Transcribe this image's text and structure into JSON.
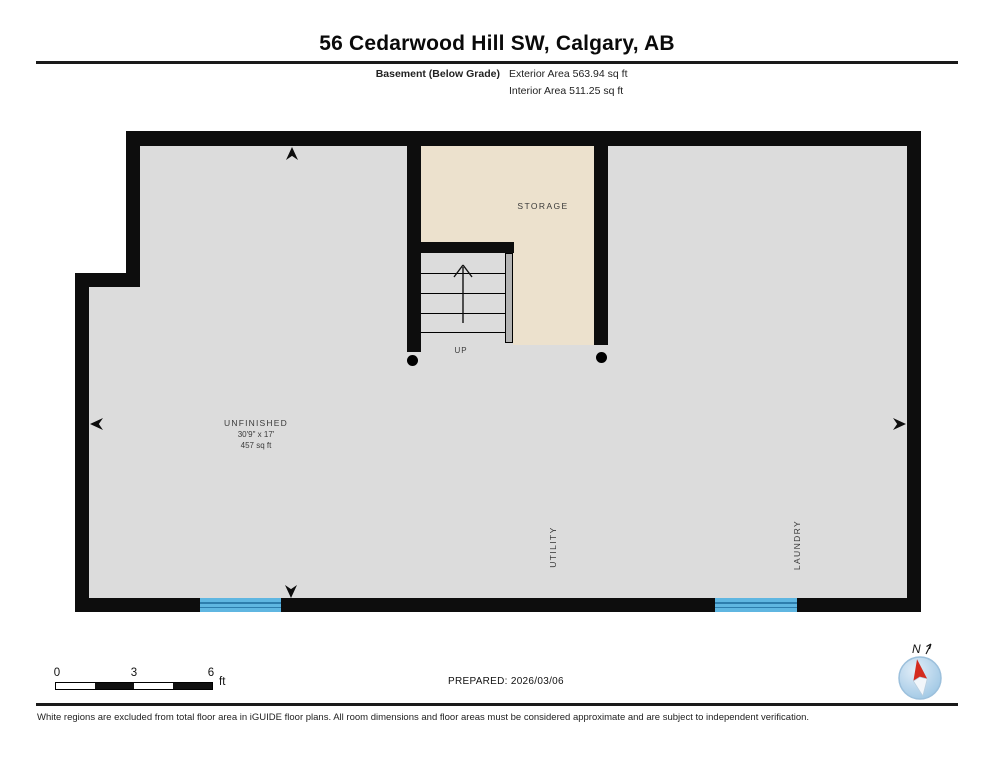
{
  "header": {
    "title": "56 Cedarwood Hill SW, Calgary, AB",
    "floor_label": "Basement (Below Grade)",
    "exterior_area": "Exterior Area 563.94 sq ft",
    "interior_area": "Interior Area 511.25 sq ft"
  },
  "plan": {
    "labels": {
      "storage": "STORAGE",
      "unfinished_name": "UNFINISHED",
      "unfinished_dimensions": "30'9\" x 17'",
      "unfinished_area": "457 sq ft",
      "utility": "UTILITY",
      "laundry": "LAUNDRY",
      "stairs_up": "UP"
    },
    "colors": {
      "wall": "#0d0d0d",
      "floor": "#dcdcdc",
      "storage_floor": "#ece1cd",
      "window": "#5fb6e1",
      "window_line": "#2d7dad",
      "handrail": "#b3b3b3",
      "compass_needle": "#d42b1e"
    }
  },
  "footer": {
    "scale_bar": {
      "tick_0": "0",
      "tick_3": "3",
      "tick_6": "6",
      "unit": "ft"
    },
    "prepared": "PREPARED: 2026/03/06",
    "compass_label": "N",
    "disclaimer": "White regions are excluded from total floor area in iGUIDE floor plans. All room dimensions and floor areas must be considered approximate and are subject to independent verification."
  }
}
